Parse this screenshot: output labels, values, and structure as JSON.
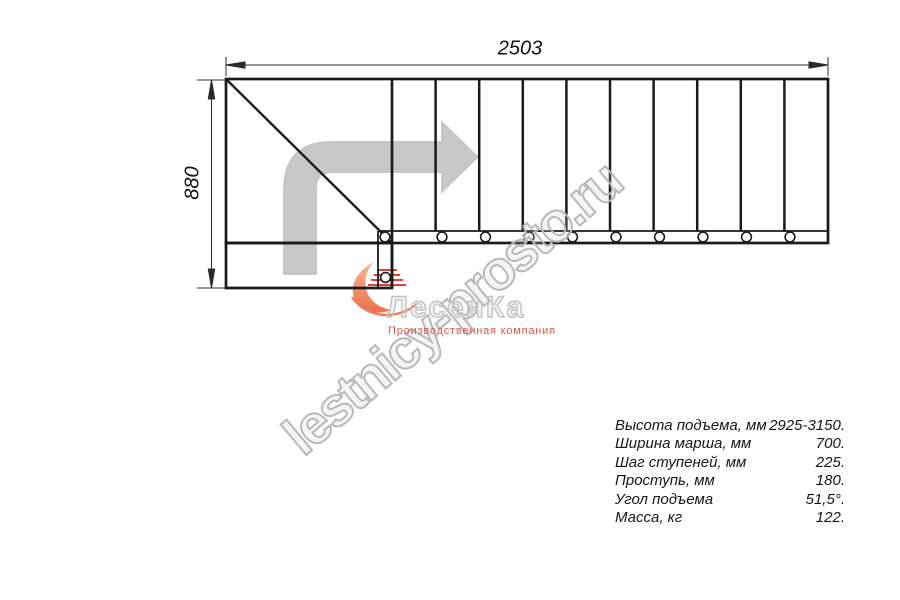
{
  "page": {
    "background": "#ffffff"
  },
  "dimensions": {
    "width_label": "2503",
    "height_label": "880"
  },
  "watermark": {
    "text": "lestnicy-prosto.ru",
    "color": "#b9b9b9",
    "angle_deg": -40
  },
  "logo": {
    "name": "ЛесенКа",
    "subtitle": "Производственная компания",
    "subtitle_color": "#e2574c",
    "mark_orange_light": "#f6b28e",
    "mark_orange_dark": "#eb6a43",
    "mark_red": "#d9453a",
    "name_gray": "#c2c2c2"
  },
  "specs": {
    "rows": [
      {
        "label": "Высота подъема, мм",
        "value": "2925-3150."
      },
      {
        "label": "Ширина марша, мм",
        "value": "700."
      },
      {
        "label": "Шаг ступеней, мм",
        "value": "225."
      },
      {
        "label": "Проступь, мм",
        "value": "180."
      },
      {
        "label": "Угол подъема",
        "value": "51,5°."
      },
      {
        "label": "Масса, кг",
        "value": "122."
      }
    ]
  },
  "drawing": {
    "type": "stair-plan-top-view",
    "line_color": "#1a1a1a",
    "dim_color": "#2a2a2a",
    "arrow_color": "#c7c7c7",
    "plan": {
      "outer": {
        "x1": 226,
        "y1": 79,
        "x2": 828,
        "y2": 243
      },
      "winder_right_x": 392,
      "stringer_inner_x": 378,
      "strip_top_y": 231,
      "bottom_step": {
        "x1": 226,
        "y1": 243,
        "x2": 392,
        "y2": 288
      },
      "diagonal": {
        "x1": 227,
        "y1": 80,
        "x2": 391,
        "y2": 242
      },
      "tread_xs": [
        435.6,
        479.2,
        522.8,
        566.4,
        610.0,
        653.6,
        697.2,
        740.8,
        784.4
      ],
      "post_circles": [
        [
          385,
          237
        ],
        [
          442,
          237
        ],
        [
          485.5,
          237
        ],
        [
          529,
          237
        ],
        [
          572.5,
          237
        ],
        [
          616,
          237
        ],
        [
          659.5,
          237
        ],
        [
          703,
          237
        ],
        [
          746.5,
          237
        ],
        [
          790,
          237
        ],
        [
          385.5,
          277.5
        ]
      ],
      "circle_r": 4.9
    }
  }
}
